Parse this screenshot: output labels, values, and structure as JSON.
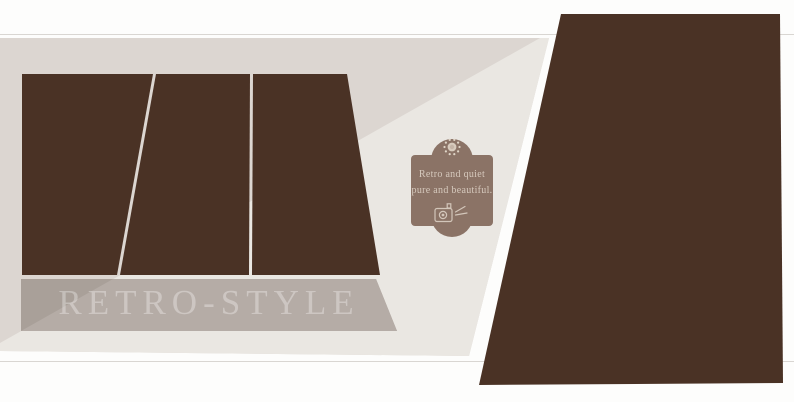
{
  "page": {
    "background": "#fdfdfc",
    "hairline_color": "#d9d6d2"
  },
  "canvas": {
    "base_color": "#dcd6d1",
    "light_color": "#eae7e2"
  },
  "photo_panels": {
    "color": "#4a3225",
    "left_panel_count": 3,
    "right_panel_count": 1
  },
  "title_band": {
    "label": "RETRO-STYLE",
    "dark_color": "#a9a099",
    "light_color": "#b5aca6",
    "text_color": "rgba(255,255,255,0.32)"
  },
  "badge": {
    "line1": "Retro and quiet",
    "line2": "pure and beautiful.",
    "bg_color": "#8b7366",
    "text_color": "#d6c9bd",
    "top_icon": "sun-icon",
    "bottom_icon": "tv-icon"
  }
}
